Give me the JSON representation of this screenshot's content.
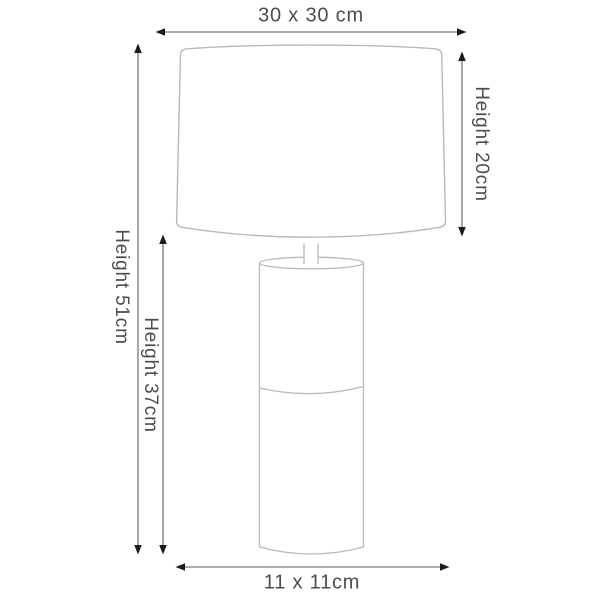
{
  "diagram": {
    "name": "table-lamp-dimension-diagram",
    "labels": {
      "shade_width": "30 x 30 cm",
      "shade_height": "Height 20cm",
      "total_height": "Height 51cm",
      "base_height": "Height 37cm",
      "base_width": "11 x 11cm"
    },
    "colors": {
      "lamp_outline": "#b9b9b9",
      "dimension_line": "#8f8f8f",
      "arrowhead": "#1c1c1c",
      "text": "#4d4d4d",
      "background": "#ffffff"
    }
  }
}
